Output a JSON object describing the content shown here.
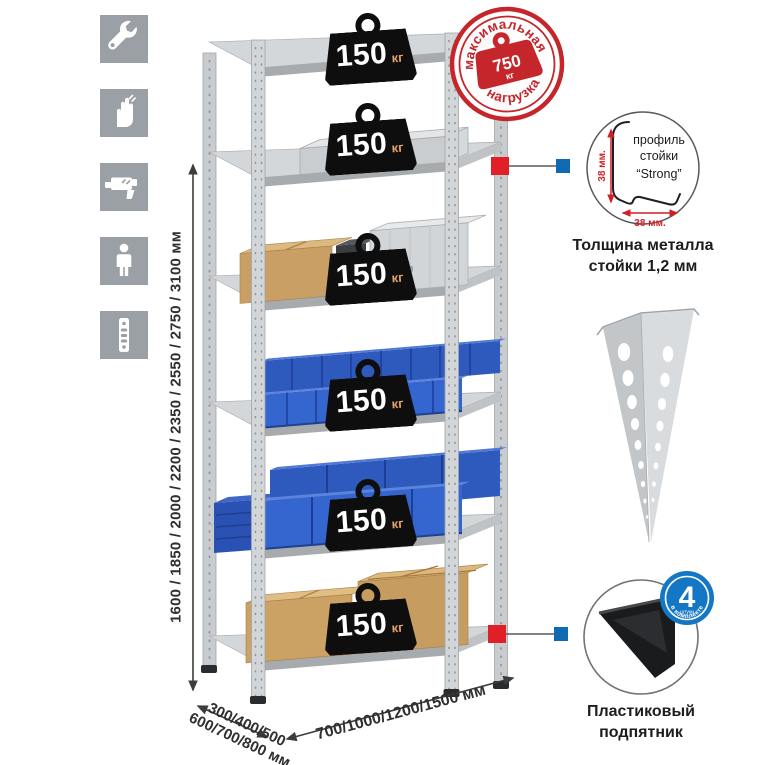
{
  "sidebar": {
    "icons": [
      {
        "name": "wrench-icon"
      },
      {
        "name": "gloves-icon"
      },
      {
        "name": "drill-icon"
      },
      {
        "name": "person-icon"
      },
      {
        "name": "perforated-post-icon"
      }
    ]
  },
  "rack": {
    "shelf_count": "6",
    "badges": [
      {
        "value": "150",
        "unit": "кг"
      },
      {
        "value": "150",
        "unit": "кг"
      },
      {
        "value": "150",
        "unit": "кг"
      },
      {
        "value": "150",
        "unit": "кг"
      },
      {
        "value": "150",
        "unit": "кг"
      },
      {
        "value": "150",
        "unit": "кг"
      }
    ]
  },
  "stamp": {
    "arc_top": "максимальная",
    "arc_bottom": "нагрузка",
    "value": "750",
    "unit": "кг"
  },
  "dimensions": {
    "height": "1600 / 1850 / 2000 / 2200 / 2350 / 2550 / 2750 / 3100 мм",
    "depth_line1": "300/400/500",
    "depth_line2": "600/700/800 мм",
    "width": "700/1000/1200/1500 мм"
  },
  "profile_callout": {
    "label_line1": "профиль",
    "label_line2": "стойки",
    "label_line3": "“Strong”",
    "dim_vertical": "38 мм.",
    "dim_horizontal": "38 мм.",
    "caption_line1": "Толщина металла",
    "caption_line2": "стойки 1,2 мм"
  },
  "foot_callout": {
    "badge_value": "4",
    "badge_unit": "штуки",
    "badge_arc": "в комплекте",
    "caption_line1": "Пластиковый",
    "caption_line2": "подпятник"
  },
  "colors": {
    "accent_red": "#cc2629",
    "accent_blue": "#1273bd",
    "badge_black": "#0e0e0e",
    "bin_blue": "#3060c8",
    "metal_gray": "#d2d5d7",
    "icon_gray": "#9aa0a5"
  }
}
